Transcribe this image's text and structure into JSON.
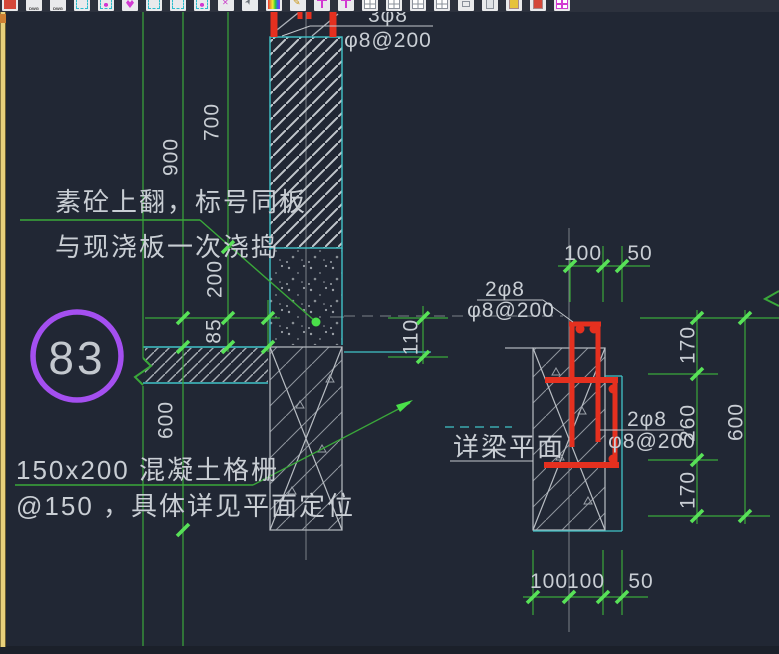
{
  "toolbar": {
    "icons": [
      {
        "name": "new-file-icon",
        "glyph": "red",
        "label": ""
      },
      {
        "name": "dwg-file-icon-1",
        "glyph": "dwg",
        "label": "DWG"
      },
      {
        "name": "dwg-file-icon-2",
        "glyph": "dwg",
        "label": "DWG"
      },
      {
        "name": "paste-block-icon",
        "glyph": "cyan",
        "label": ""
      },
      {
        "name": "insert-block-icon",
        "glyph": "cyanm",
        "label": ""
      },
      {
        "name": "favorite-tool-icon",
        "glyph": "heart",
        "label": ""
      },
      {
        "name": "copy-block-icon-1",
        "glyph": "cyan",
        "label": ""
      },
      {
        "name": "copy-block-icon-2",
        "glyph": "cyan",
        "label": ""
      },
      {
        "name": "block-edit-icon",
        "glyph": "cyanm",
        "label": ""
      },
      {
        "name": "explode-icon",
        "glyph": "mx",
        "label": ""
      },
      {
        "name": "select-cursor-icon",
        "glyph": "cursor",
        "label": ""
      },
      {
        "name": "color-palette-icon",
        "glyph": "rainbow",
        "label": ""
      },
      {
        "name": "edit-pencil-icon",
        "glyph": "pencil",
        "label": ""
      },
      {
        "name": "axis-tool-icon-1",
        "glyph": "pin",
        "label": ""
      },
      {
        "name": "axis-tool-icon-2",
        "glyph": "pin",
        "label": ""
      },
      {
        "name": "layout-grid-icon-1",
        "glyph": "grid",
        "label": ""
      },
      {
        "name": "layout-grid-icon-2",
        "glyph": "grid",
        "label": ""
      },
      {
        "name": "layout-grid-icon-3",
        "glyph": "grid",
        "label": ""
      },
      {
        "name": "layout-grid-icon-4",
        "glyph": "grid",
        "label": ""
      },
      {
        "name": "small-box-icon",
        "glyph": "small",
        "label": ""
      },
      {
        "name": "clipboard-icon",
        "glyph": "clip",
        "label": ""
      },
      {
        "name": "doc-yellow-icon",
        "glyph": "docy",
        "label": ""
      },
      {
        "name": "doc-red-icon",
        "glyph": "docr",
        "label": ""
      },
      {
        "name": "table-tool-icon",
        "glyph": "table",
        "label": ""
      }
    ]
  },
  "callout": {
    "number": "83"
  },
  "notes": {
    "note1_line1": "素砼上翻，标号同板",
    "note1_line2": "与现浇板一次浇捣",
    "note2_line1": "150x200  混凝土格栅",
    "note2_line2": "@150 ，具体详见平面定位",
    "beam_plan_label": "详梁平面"
  },
  "rebar_labels": {
    "top_line1": "3φ8",
    "top_line2": "φ8@200",
    "mid_line1": "2φ8",
    "mid_line2": "φ8@200",
    "right_line1": "2φ8",
    "right_line2": "φ8@200"
  },
  "dims": {
    "d700": "700",
    "d900": "900",
    "d200": "200",
    "d85": "85",
    "d600_left": "600",
    "d110": "110",
    "d100_top": "100",
    "d50_top": "50",
    "d170_top": "170",
    "d260": "260",
    "d600_right": "600",
    "d170_bottom": "170",
    "d100_b1": "100",
    "d100_b2": "100",
    "d50_b": "50"
  },
  "colors": {
    "background": "#212734",
    "dim_green": "#3aa83a",
    "tick_green": "#58e158",
    "outline_cyan": "#41c4c8",
    "line_gray": "#a6abb3",
    "rebar_red": "#e5301f",
    "callout_purple": "#a44ff0",
    "text_light": "#c9ced4",
    "strip_yellow": "#e7d07b"
  }
}
